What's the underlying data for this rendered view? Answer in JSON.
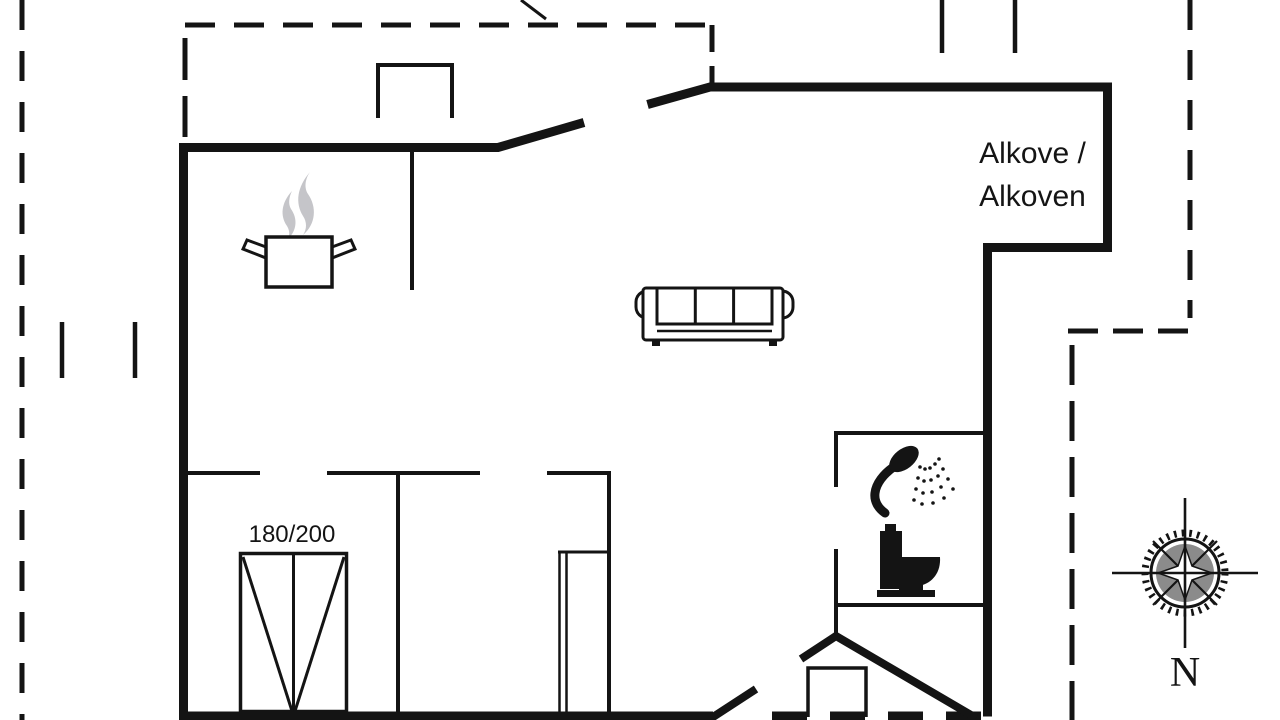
{
  "title": "Holiday house floor plan",
  "labels": {
    "alcove_line1": "Alkove /",
    "alcove_line2": "Alkoven",
    "bed_size": "180/200",
    "compass_north": "N"
  },
  "icons": {
    "cooking_pot": "steaming pot (kitchen/stove)",
    "sofa": "three-seat sofa",
    "double_bed": "double bed with V mattress marks",
    "wardrobe": "wardrobe with sliding double doors",
    "shower": "hand shower with spray",
    "toilet": "toilet side silhouette",
    "compass_rose": "compass rose, north up"
  },
  "colors": {
    "ink": "#141414",
    "steam_gray": "#c5c5c9",
    "compass_gray": "#777777",
    "background": "#ffffff"
  }
}
